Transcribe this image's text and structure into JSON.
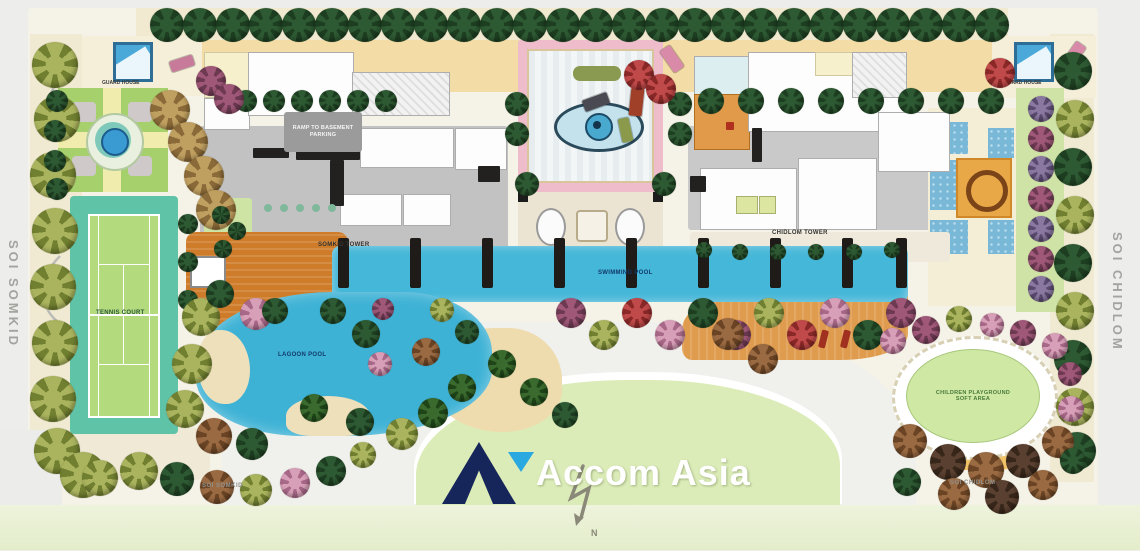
{
  "roads": {
    "left": "SOI SOMKID",
    "right": "SOI CHIDLOM",
    "bottom_left": "SOI SOMKID",
    "bottom_right": "SOI CHIDLOM"
  },
  "towers": {
    "left": "SOMKID TOWER",
    "right": "CHIDLOM TOWER"
  },
  "amenities": {
    "tennis": "TENNIS COURT",
    "lagoon_pool": "LAGOON POOL",
    "swimming_pool": "SWIMMING POOL",
    "playground_line1": "CHILDREN PLAYGROUND",
    "playground_line2": "SOFT AREA",
    "ramp": "RAMP TO BASEMENT PARKING",
    "guard": "GUARD HOUSE"
  },
  "logo": {
    "brand": "Accom Asia"
  },
  "compass": {
    "north": "N"
  },
  "colors": {
    "brand_navy": "#16265a",
    "brand_blue": "#2aa9e0",
    "pool_blue": "#45b7d8",
    "deck_orange": "#cf7c2a",
    "lawn_green": "#cfe8a4",
    "tennis_surround": "#5fc3a7",
    "tennis_court": "#b3da7c",
    "plaza_pink": "#eebccb",
    "tree_dark_green": "#2e5a33",
    "road_tan": "#f3dca6"
  }
}
